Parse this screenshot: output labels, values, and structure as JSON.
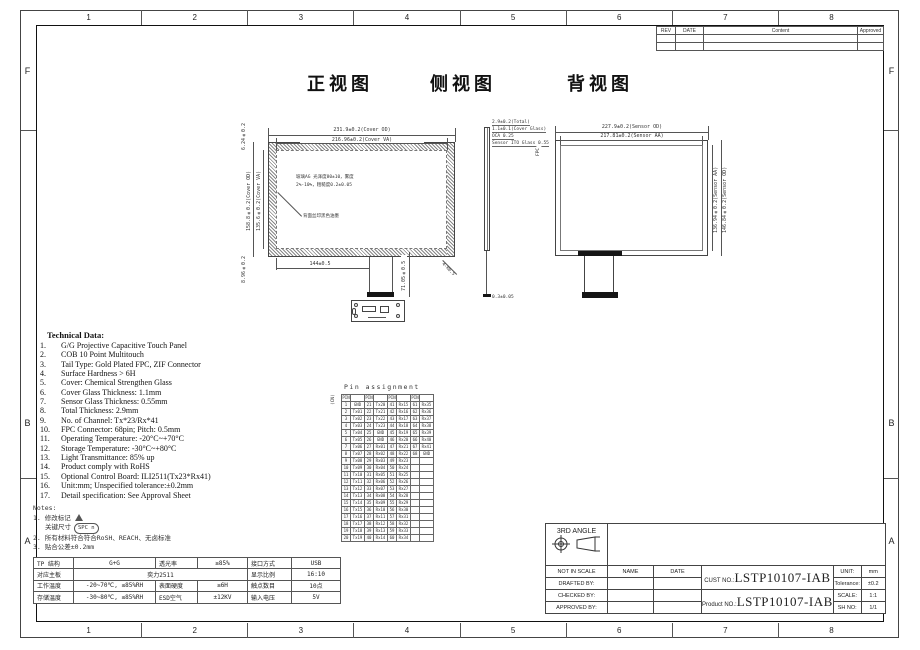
{
  "sheet": {
    "zone_numbers": [
      "1",
      "2",
      "3",
      "4",
      "5",
      "6",
      "7",
      "8"
    ],
    "side_letters": [
      "F",
      "B",
      "A"
    ]
  },
  "rev_table": {
    "headers": [
      "REV",
      "DATE",
      "Content",
      "Approved"
    ]
  },
  "views": {
    "front_title": "正视图",
    "side_title": "侧视图",
    "back_title": "背视图"
  },
  "front_view": {
    "dim_cover_od_w": "231.9±0.2(Cover OD)",
    "dim_cover_va_w": "216.96±0.2(Cover VA)",
    "dim_cover_od_h": "158.8±0.2(Cover OD)",
    "dim_cover_va_h": "135.6±0.2(Cover VA)",
    "dim_top_left": "6.24±0.2",
    "dim_bottom_left": "8.96±0.2",
    "dim_bottom_width": "144±0.5",
    "dim_tail_length": "71.05±0.5",
    "dim_corner_radius": "4-R0.5",
    "ag_note_line1": "玻璃AG 光泽度80±10，雾度",
    "ag_note_line2": "2%-10%，粗糙度0.2±0.05",
    "ink_note": "背面丝印黑色油墨"
  },
  "side_view": {
    "label_total": "2.9±0.2(Total)",
    "label_cover": "1.1±0.1(Cover Glass)",
    "label_oca": "OCA 0.25",
    "label_sensor": "Sensor ITO Glass 0.55",
    "label_fpc": "FPC",
    "label_bottom": "0.3±0.05"
  },
  "back_view": {
    "dim_sensor_od_w": "227.9±0.2(Sensor OD)",
    "dim_sensor_aa_w": "217.81±0.2(Sensor AA)",
    "dim_sensor_aa_h": "136.94±0.2(Sensor AA)",
    "dim_sensor_od_h": "146.84±0.2(Sensor OD)"
  },
  "technical_data": {
    "title": "Technical Data:",
    "items": [
      "G/G Projective Capacitive Touch Panel",
      "COB 10 Point Multitouch",
      "Tail Type: Gold Plated FPC, ZIF Connector",
      "Surface Hardness > 6H",
      "Cover: Chemical Strengthen Glass",
      "Cover Glass Thickness: 1.1mm",
      "Sensor Glass Thickness: 0.55mm",
      "Total Thickness: 2.9mm",
      "No. of Channel: Tx*23/Rx*41",
      "FPC Connector: 68pin; Pitch: 0.5mm",
      "Operating Temperature: -20°C~+70°C",
      "Storage Temperature: -30°C~+80°C",
      "Light Transmittance: 85% up",
      "Product comply with RoHS",
      "Optional Control Board: ILI2511(Tx23*Rx41)",
      "Unit:mm; Unspecified tolerance:±0.2mm",
      "Detail specification: See Approval Sheet"
    ]
  },
  "notes": {
    "title": "Notes:",
    "item1": "1. 修改标记",
    "revision_mark": "n",
    "item1b": "关键尺寸",
    "spc_mark": "SPC n",
    "item2": "2. 所有材料符合符合RoSH、REACH、无卤标准",
    "item3": "3. 贴合公差±0.2mm"
  },
  "pin_table": {
    "title": "Pin assignment",
    "side_label": "(CN)",
    "col_header": "PIN",
    "pins": [
      {
        "no": "1",
        "sig": "GND"
      },
      {
        "no": "2",
        "sig": "Tx01"
      },
      {
        "no": "3",
        "sig": "Tx02"
      },
      {
        "no": "4",
        "sig": "Tx03"
      },
      {
        "no": "5",
        "sig": "Tx04"
      },
      {
        "no": "6",
        "sig": "Tx05"
      },
      {
        "no": "7",
        "sig": "Tx06"
      },
      {
        "no": "8",
        "sig": "Tx07"
      },
      {
        "no": "9",
        "sig": "Tx08"
      },
      {
        "no": "10",
        "sig": "Tx09"
      },
      {
        "no": "11",
        "sig": "Tx10"
      },
      {
        "no": "12",
        "sig": "Tx11"
      },
      {
        "no": "13",
        "sig": "Tx12"
      },
      {
        "no": "14",
        "sig": "Tx13"
      },
      {
        "no": "15",
        "sig": "Tx14"
      },
      {
        "no": "16",
        "sig": "Tx15"
      },
      {
        "no": "17",
        "sig": "Tx16"
      },
      {
        "no": "18",
        "sig": "Tx17"
      },
      {
        "no": "19",
        "sig": "Tx18"
      },
      {
        "no": "20",
        "sig": "Tx19"
      },
      {
        "no": "21",
        "sig": "Tx20"
      },
      {
        "no": "22",
        "sig": "Tx21"
      },
      {
        "no": "23",
        "sig": "Tx22"
      },
      {
        "no": "24",
        "sig": "Tx23"
      },
      {
        "no": "25",
        "sig": "GND"
      },
      {
        "no": "26",
        "sig": "GND"
      },
      {
        "no": "27",
        "sig": "Rx01"
      },
      {
        "no": "28",
        "sig": "Rx02"
      },
      {
        "no": "29",
        "sig": "Rx03"
      },
      {
        "no": "30",
        "sig": "Rx04"
      },
      {
        "no": "31",
        "sig": "Rx05"
      },
      {
        "no": "32",
        "sig": "Rx06"
      },
      {
        "no": "33",
        "sig": "Rx07"
      },
      {
        "no": "34",
        "sig": "Rx08"
      },
      {
        "no": "35",
        "sig": "Rx09"
      },
      {
        "no": "36",
        "sig": "Rx10"
      },
      {
        "no": "37",
        "sig": "Rx11"
      },
      {
        "no": "38",
        "sig": "Rx12"
      },
      {
        "no": "39",
        "sig": "Rx13"
      },
      {
        "no": "40",
        "sig": "Rx14"
      },
      {
        "no": "41",
        "sig": "Rx15"
      },
      {
        "no": "42",
        "sig": "Rx16"
      },
      {
        "no": "43",
        "sig": "Rx17"
      },
      {
        "no": "44",
        "sig": "Rx18"
      },
      {
        "no": "45",
        "sig": "Rx19"
      },
      {
        "no": "46",
        "sig": "Rx20"
      },
      {
        "no": "47",
        "sig": "Rx21"
      },
      {
        "no": "48",
        "sig": "Rx22"
      },
      {
        "no": "49",
        "sig": "Rx23"
      },
      {
        "no": "50",
        "sig": "Rx24"
      },
      {
        "no": "51",
        "sig": "Rx25"
      },
      {
        "no": "52",
        "sig": "Rx26"
      },
      {
        "no": "53",
        "sig": "Rx27"
      },
      {
        "no": "54",
        "sig": "Rx28"
      },
      {
        "no": "55",
        "sig": "Rx29"
      },
      {
        "no": "56",
        "sig": "Rx30"
      },
      {
        "no": "57",
        "sig": "Rx31"
      },
      {
        "no": "58",
        "sig": "Rx32"
      },
      {
        "no": "59",
        "sig": "Rx33"
      },
      {
        "no": "60",
        "sig": "Rx34"
      },
      {
        "no": "61",
        "sig": "Rx35"
      },
      {
        "no": "62",
        "sig": "Rx36"
      },
      {
        "no": "63",
        "sig": "Rx37"
      },
      {
        "no": "64",
        "sig": "Rx38"
      },
      {
        "no": "65",
        "sig": "Rx39"
      },
      {
        "no": "66",
        "sig": "Rx40"
      },
      {
        "no": "67",
        "sig": "Rx41"
      },
      {
        "no": "68",
        "sig": "GND"
      }
    ]
  },
  "spec_table": {
    "rows": [
      [
        {
          "t": "TP 结构"
        },
        {
          "t": "G+G"
        },
        {
          "t": "透光率"
        },
        {
          "t": "≥85%"
        },
        {
          "t": "接口方式"
        },
        {
          "t": "USB"
        }
      ],
      [
        {
          "t": "对应主板"
        },
        {
          "t": "奕力2511",
          "span": 3
        },
        {
          "t": "显示比例"
        },
        {
          "t": "16:10"
        }
      ],
      [
        {
          "t": "工作温度"
        },
        {
          "t": "-20~70℃, ≤85%RH"
        },
        {
          "t": "表面硬度"
        },
        {
          "t": "≥6H"
        },
        {
          "t": "触点数目"
        },
        {
          "t": "10点"
        }
      ],
      [
        {
          "t": "存储温度"
        },
        {
          "t": "-30~80℃, ≤85%RH"
        },
        {
          "t": "ESD空气"
        },
        {
          "t": "±12KV"
        },
        {
          "t": "输入电压"
        },
        {
          "t": "5V"
        }
      ]
    ]
  },
  "title_block": {
    "angle_label": "3RD ANGLE",
    "row_labels": [
      "NOT IN SCALE",
      "DRAFTED BY:",
      "CHECKED BY:",
      "APPROVED BY:"
    ],
    "name_header": "NAME",
    "date_header": "DATE",
    "cust_label": "CUST NO.:",
    "cust_value": "LSTP10107-IAB",
    "product_label": "Product NO.:",
    "product_value": "LSTP10107-IAB",
    "unit_label": "UNIT:",
    "unit_value": "mm",
    "tolerance_label": "Tolerance:",
    "tolerance_value": "±0.2",
    "scale_label": "SCALE:",
    "scale_value": "1:1",
    "sh_label": "SH NO:",
    "sh_value": "1/1"
  }
}
